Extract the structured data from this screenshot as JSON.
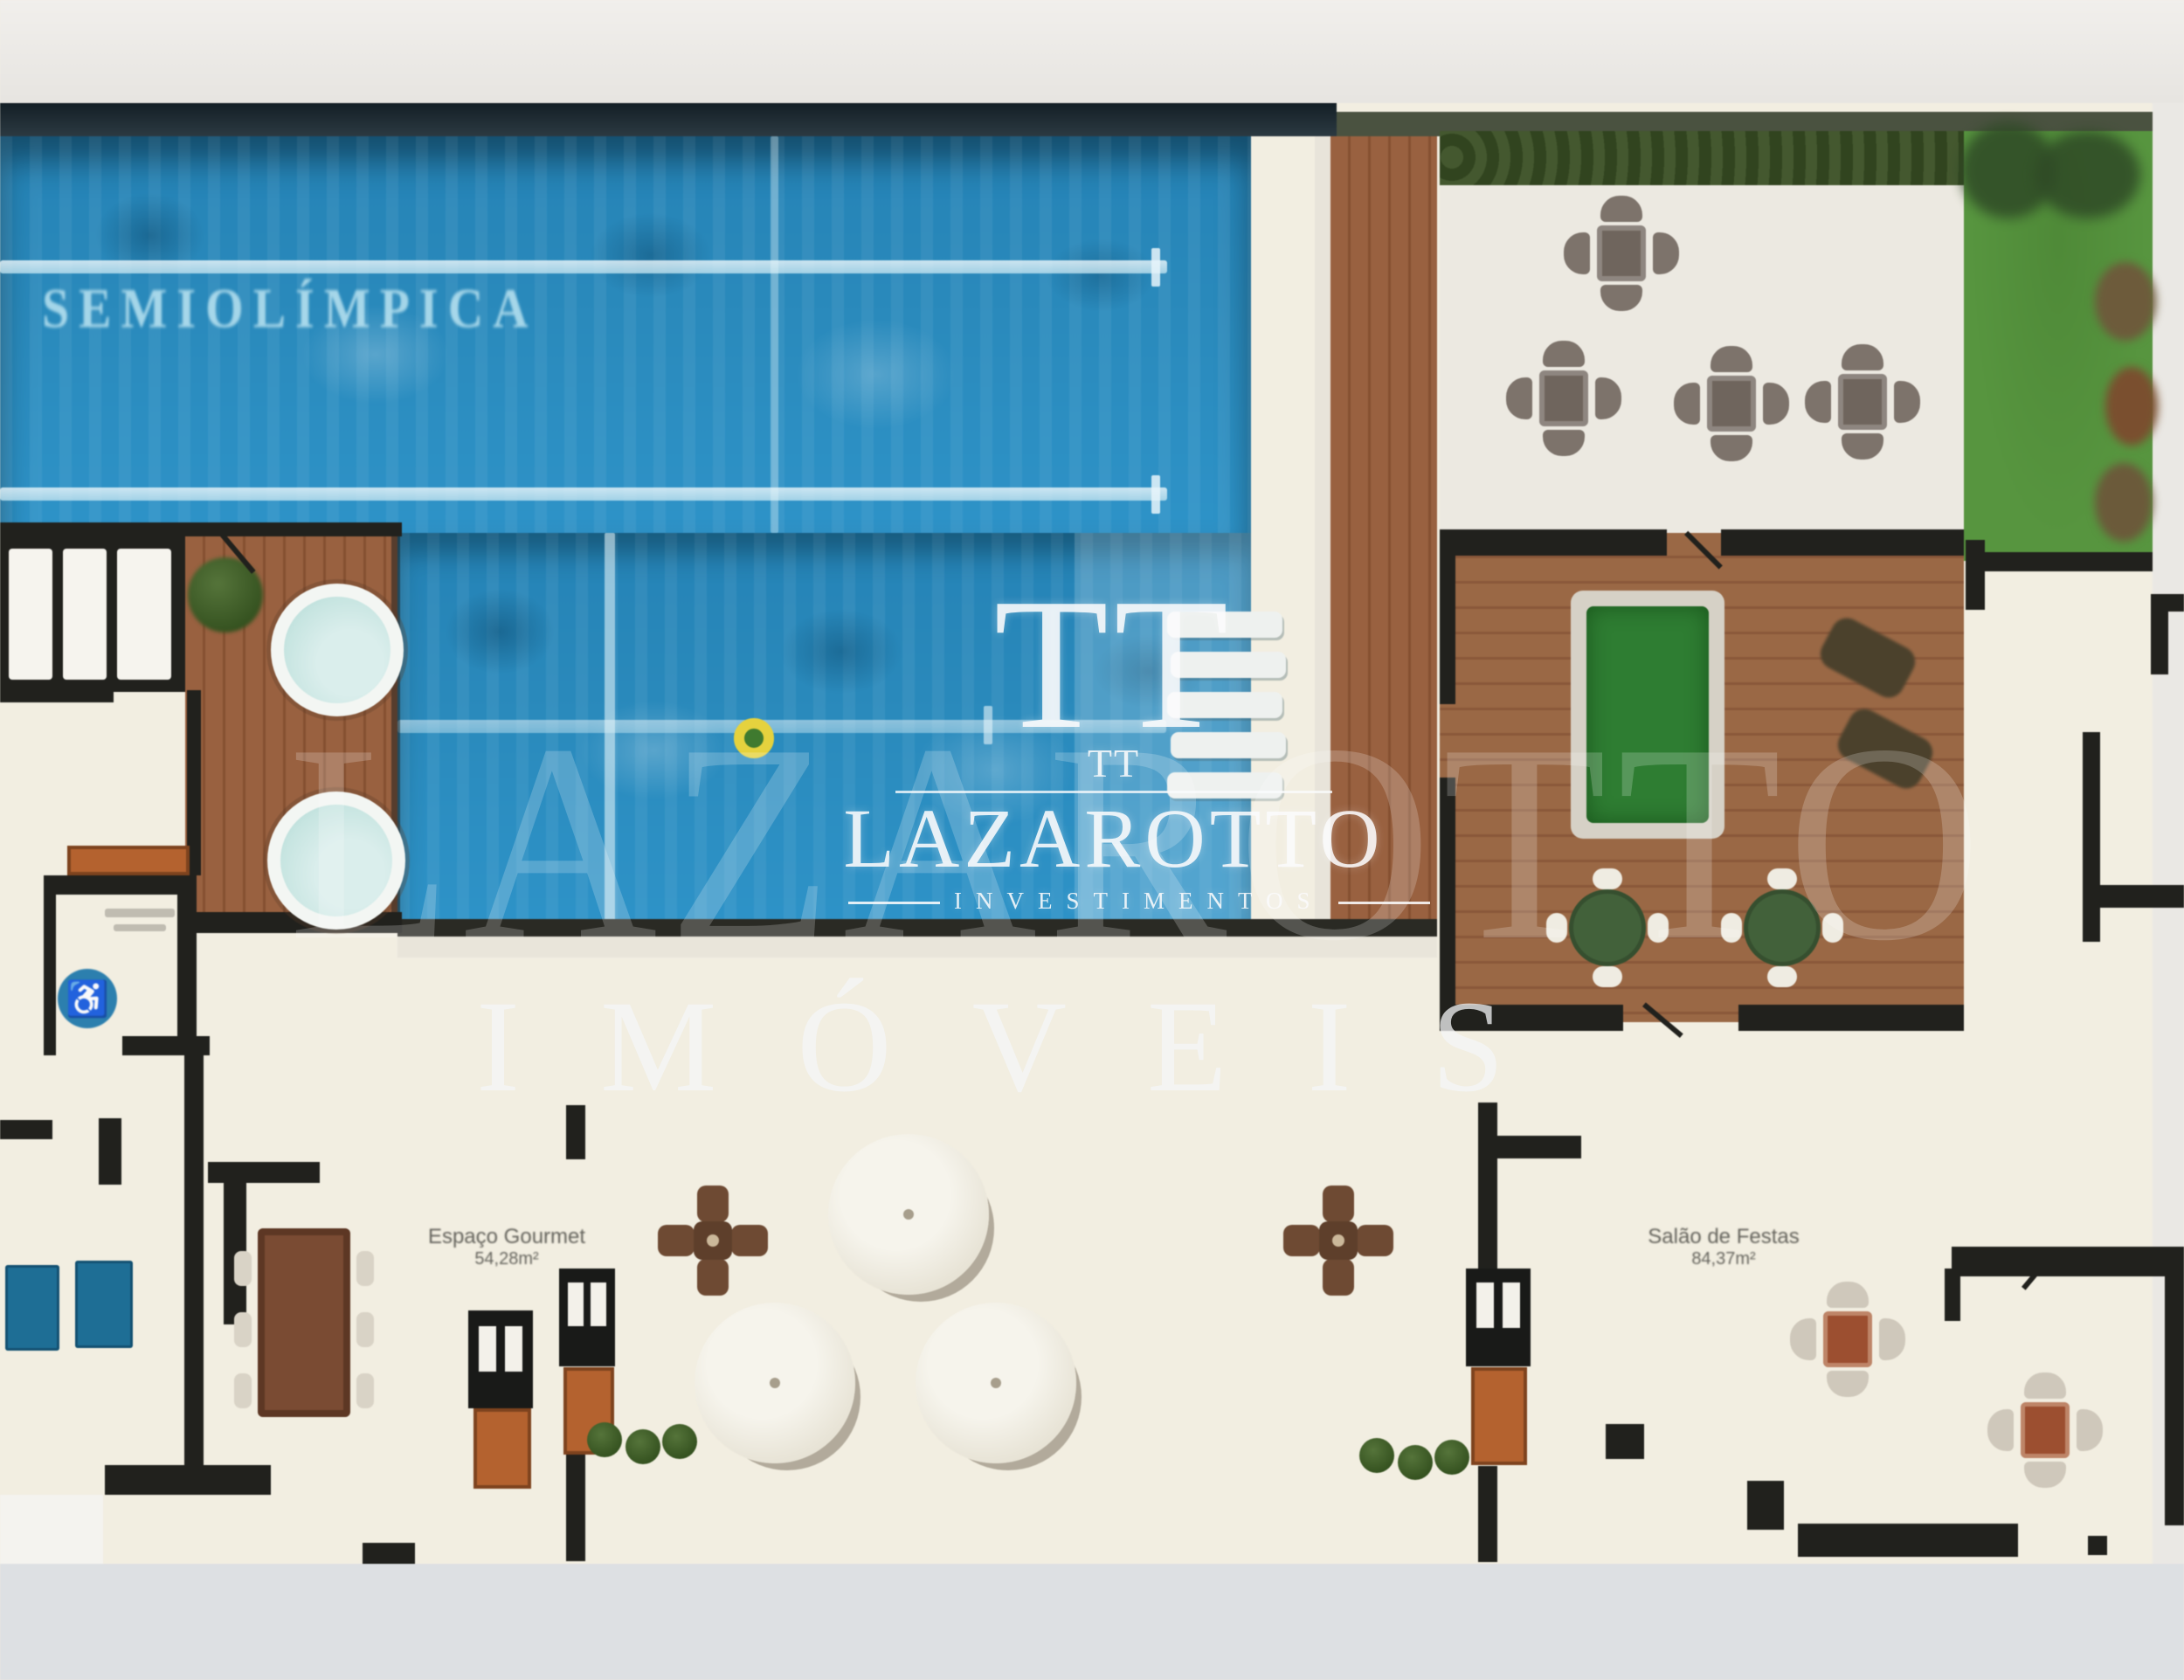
{
  "scene": {
    "kind": "real-estate leisure-deck floor plan (blurred marketing render)"
  },
  "palette": {
    "frame": "#ebe9e6",
    "frameBottom": "#dde0e3",
    "cream": "#f2eee1",
    "wall": "#21211d",
    "water": "#2a8abc",
    "laneLine": "#bfe2ef",
    "deckWood": "#996140",
    "deckWoodDark": "#855031",
    "gameWood": "#9a6845",
    "gameWoodDark": "#8a583a",
    "grass": "#57953f",
    "canopy": "#2f4a26",
    "hedge": "#31441f",
    "patio": "#ece9e1",
    "billiard": "#2e7d32",
    "billiardEdge": "#d6d1c6",
    "tableGreen": "#42613a",
    "jacuzzi": "#c7e5e1",
    "accessBlue": "#2c7fae",
    "crossTable": "#6e4a33",
    "umbrella": "#e9e5d8",
    "mats": "#1e6e95",
    "cabinet": "#b4622f",
    "seatGray": "#7d736b",
    "tableGray": "#6f655d",
    "seatLight": "#cfc8bb",
    "tableRed": "#9c4f30",
    "label": "#55544e",
    "watermark": "rgba(250,251,252,0.88)"
  },
  "pool": {
    "label": "SEMIOLÍMPICA"
  },
  "watermark": {
    "monogram": "TT",
    "monogram_small": "TT",
    "brand": "LAZAROTTO",
    "division": "INVESTIMENTOS",
    "footer": "IMÓVEIS",
    "giant": "LAZAROTTO"
  },
  "rooms": {
    "gourmet": {
      "name": "Espaço Gourmet",
      "area": "54,28m²"
    },
    "party": {
      "name": "Salão de Festas",
      "area": "84,37m²"
    }
  },
  "icons": {
    "accessibility": "♿"
  }
}
